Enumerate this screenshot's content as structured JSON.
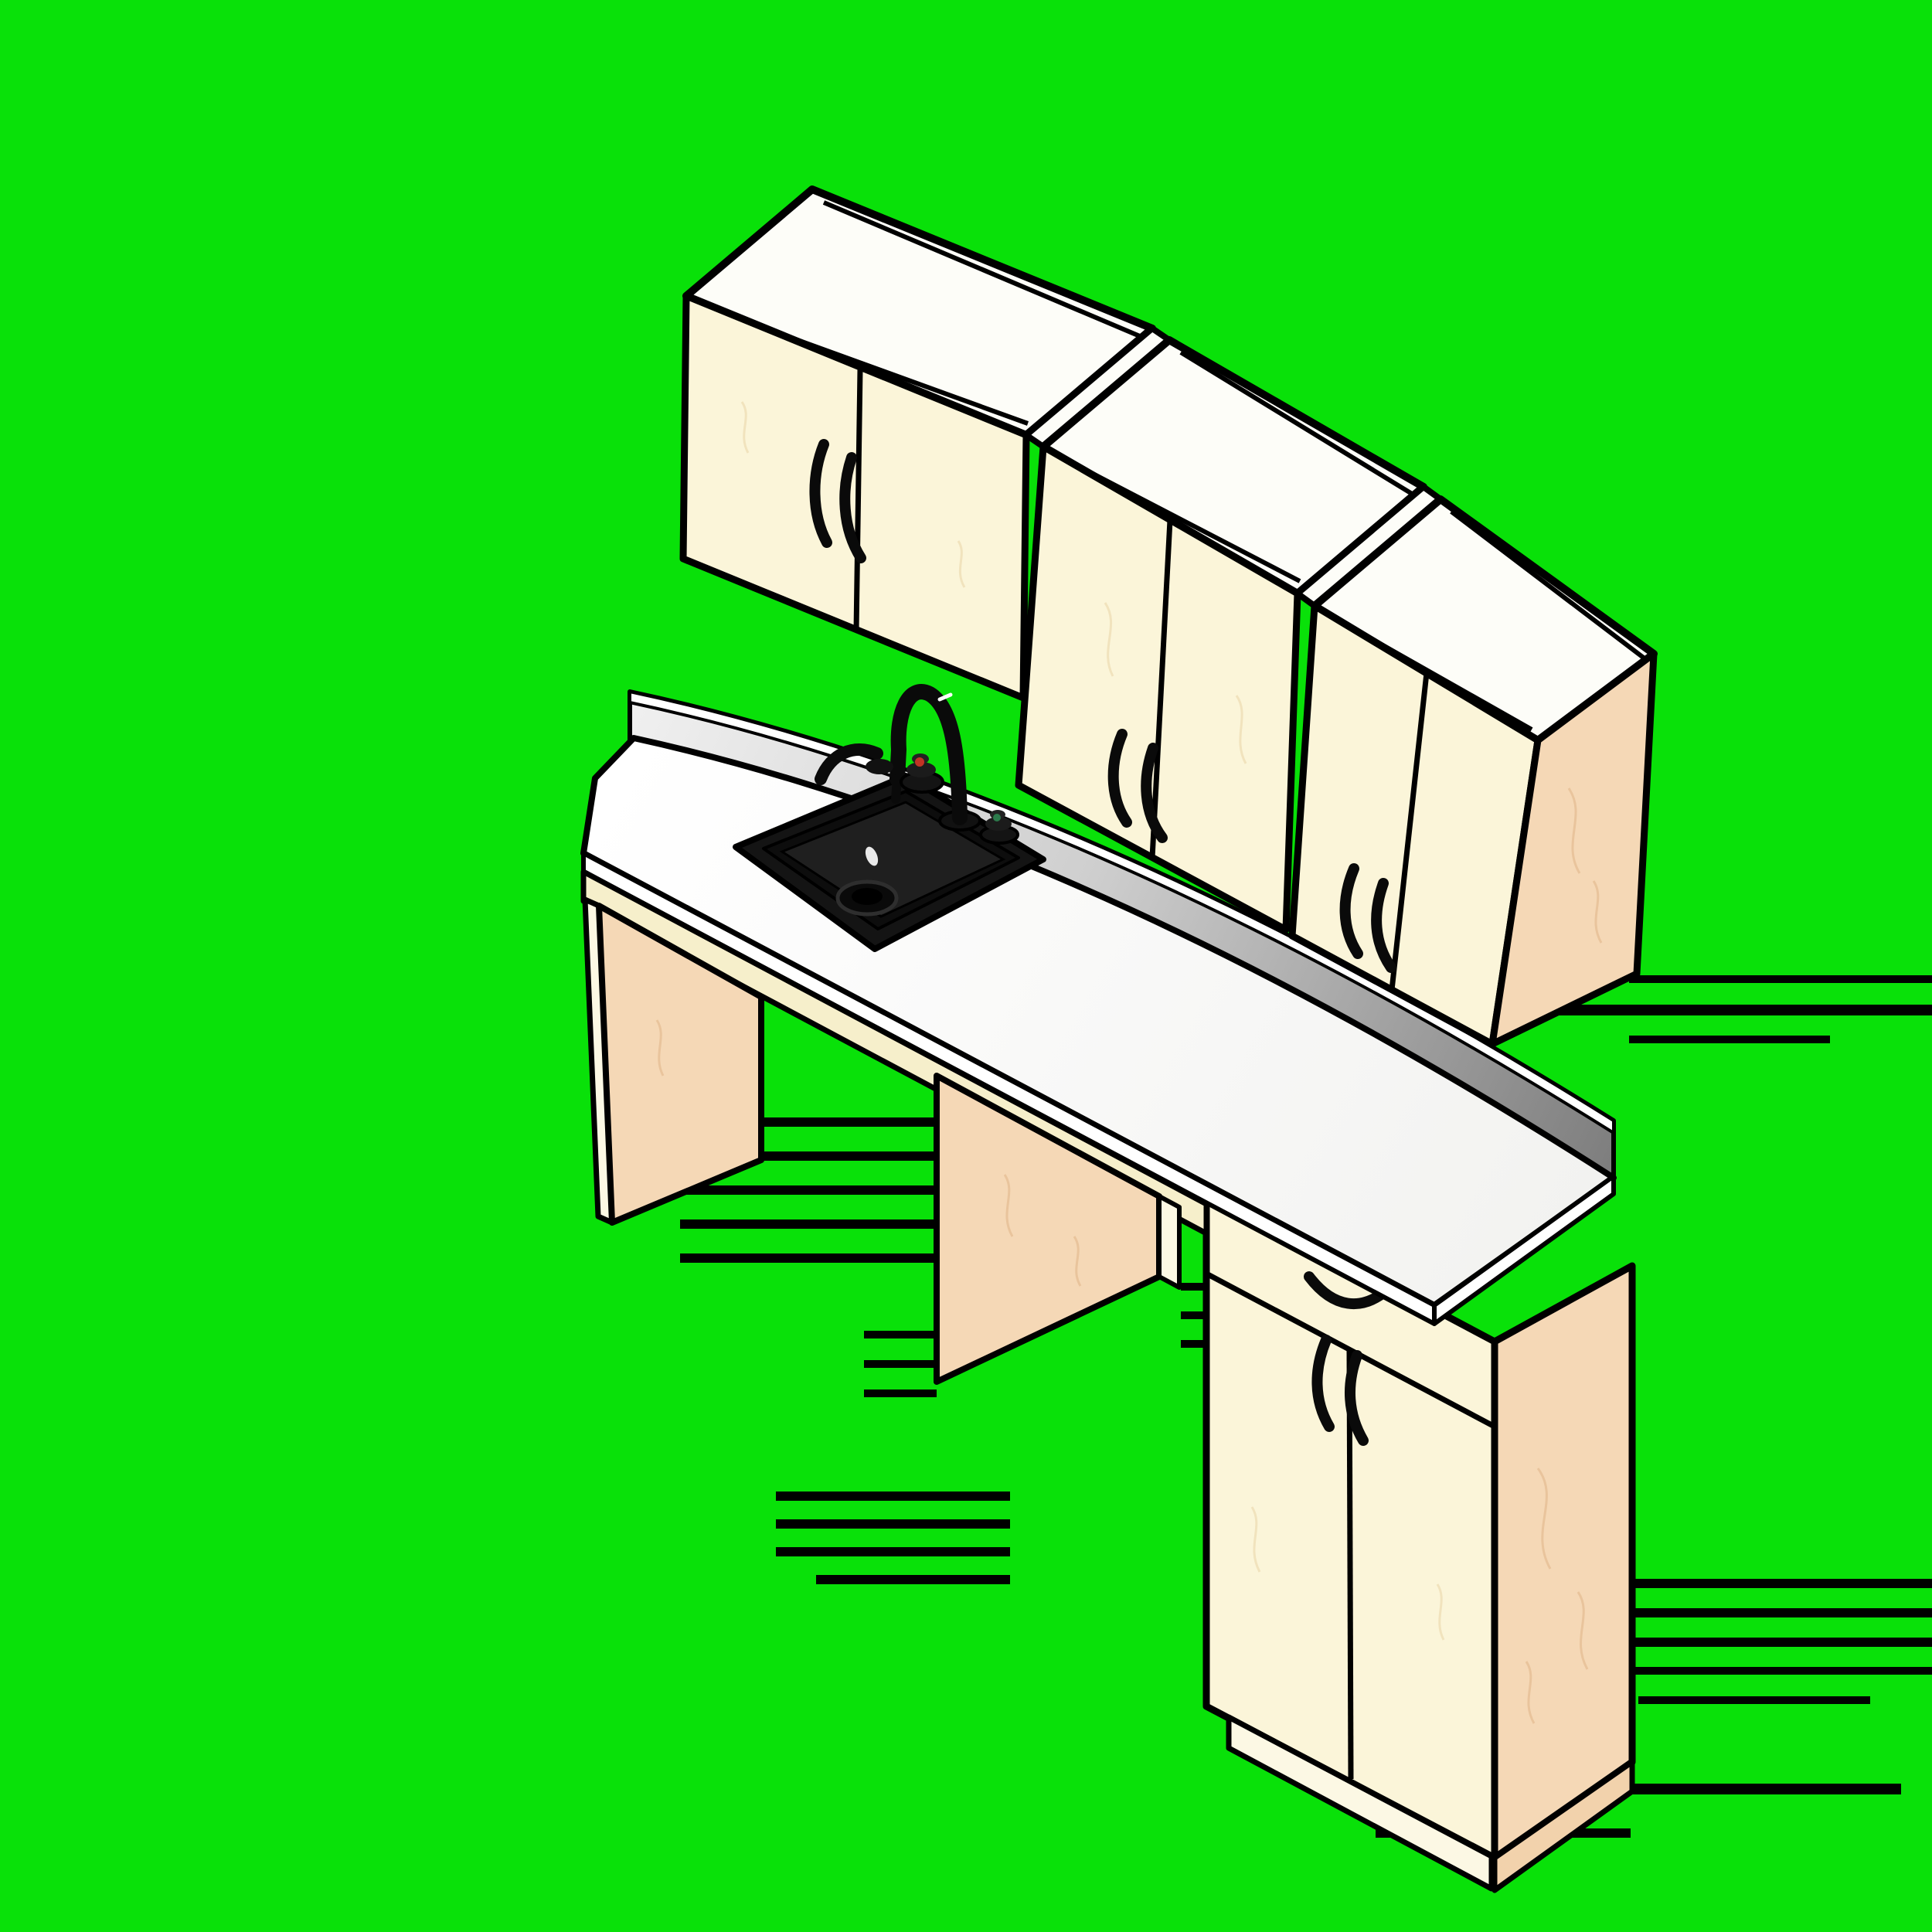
{
  "scene": {
    "type": "3d-isometric-cad-render",
    "subject": "Kitchen casework: staggered wall cabinets above a white sink countertop with open knee space and a drawer base cabinet, rendered on a chroma-key green background with shadow glitch stripes",
    "aria_label": "Isometric rendering of kitchen cabinets with black sink and faucet on green screen background"
  },
  "colors": {
    "background_green": "#09E109",
    "outline_black": "#000000",
    "cabinet_face_cream": "#FBF5D9",
    "cabinet_top_white": "#FDFDF8",
    "side_panel_peach": "#F5D8B6",
    "apron_cream": "#F6EFCB",
    "countertop_white": "#FDFDFD",
    "backsplash_gray_start": "#F0F0F0",
    "backsplash_gray_end": "#7E7E7E",
    "sink_black": "#141414",
    "hot_dot_red": "#C23325",
    "cold_dot_green": "#2C7A4B"
  },
  "inventory": {
    "wall_cabinets": [
      {
        "id": "wall-cabinet-1",
        "position": "upper-left",
        "doors": 2,
        "handles": 2,
        "style": "short deep upper, white top visible"
      },
      {
        "id": "wall-cabinet-2",
        "position": "upper-middle",
        "doors": 2,
        "handles": 2,
        "style": "tall upper, stepped down"
      },
      {
        "id": "wall-cabinet-3",
        "position": "upper-right",
        "doors": 2,
        "handles": 2,
        "style": "tall upper, exposed peach right side panel"
      }
    ],
    "counter": {
      "countertop": "white slab with front edge band",
      "backsplash": "gray gradient upstand with white top rim",
      "knee_space": true,
      "support_panels": [
        "left end panel",
        "middle divider panel"
      ],
      "sink": {
        "color": "black",
        "shape": "square drop-in",
        "drain": true,
        "faucet": "black gooseneck",
        "accessories": [
          "side sprayer lever"
        ],
        "knobs": [
          {
            "name": "hot-knob",
            "dot_color": "red"
          },
          {
            "name": "cold-knob",
            "dot_color": "green"
          }
        ]
      }
    },
    "base_cabinet": {
      "id": "base-cabinet-1",
      "position": "lower-right",
      "drawers": 1,
      "doors": 2,
      "handles": 3,
      "toe_kick": true,
      "exposed_side": "right peach panel"
    },
    "artifacts": {
      "shadow_glitch_stripes": 25
    }
  }
}
